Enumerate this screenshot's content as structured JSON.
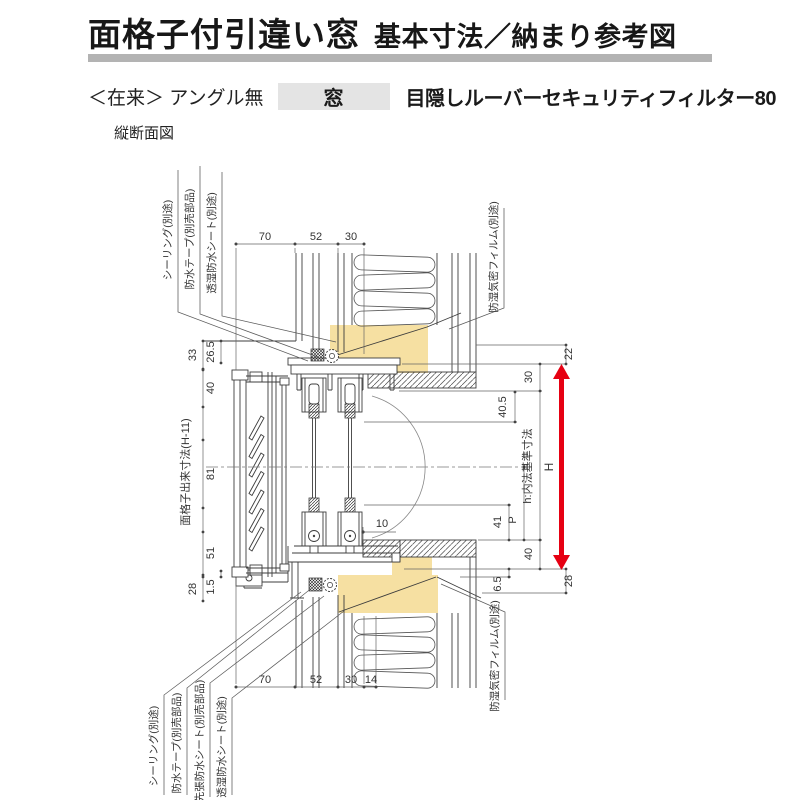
{
  "header": {
    "title": "面格子付引違い窓",
    "subtitle": "基本寸法／納まり参考図",
    "spec_prefix": "＜在来＞ アングル無",
    "spec_tag": "窓",
    "spec_product": "目隠しルーバーセキュリティフィルター80"
  },
  "drawing": {
    "caption": "縦断面図",
    "dims": {
      "top": [
        "70",
        "52",
        "30"
      ],
      "bottom": [
        "70",
        "52",
        "30",
        "14"
      ],
      "left": {
        "d33": "33",
        "d265": "26.5",
        "d40": "40",
        "d81": "81",
        "d51": "51",
        "d15": "1.5",
        "d28": "28",
        "grille_height": "面格子出来寸法(H-11)"
      },
      "right": {
        "d22": "22",
        "d30": "30",
        "d405": "40.5",
        "h_label": "h:内法基準寸法",
        "H_label": "H",
        "P_label": "P",
        "d41": "41",
        "d40": "40",
        "d65": "6.5",
        "d28": "28"
      },
      "interior_offset": "10"
    },
    "labels": {
      "top_left": [
        "シーリング(別途)",
        "防水テープ(別売部品)",
        "透湿防水シート(別途)"
      ],
      "top_right": "防湿気密フィルム(別途)",
      "bottom_left": [
        "シーリング(別途)",
        "防水テープ(別売部品)",
        "先張防水シート(別売部品)",
        "透湿防水シート(別途)"
      ],
      "bottom_right": "防湿気密フィルム(別途)"
    },
    "colors": {
      "wood_highlight": "#f6e0a2",
      "dimension_arrow_red": "#e60012",
      "title_bar": "#b3b3b3",
      "tag_bg": "#e4e4e4"
    }
  }
}
